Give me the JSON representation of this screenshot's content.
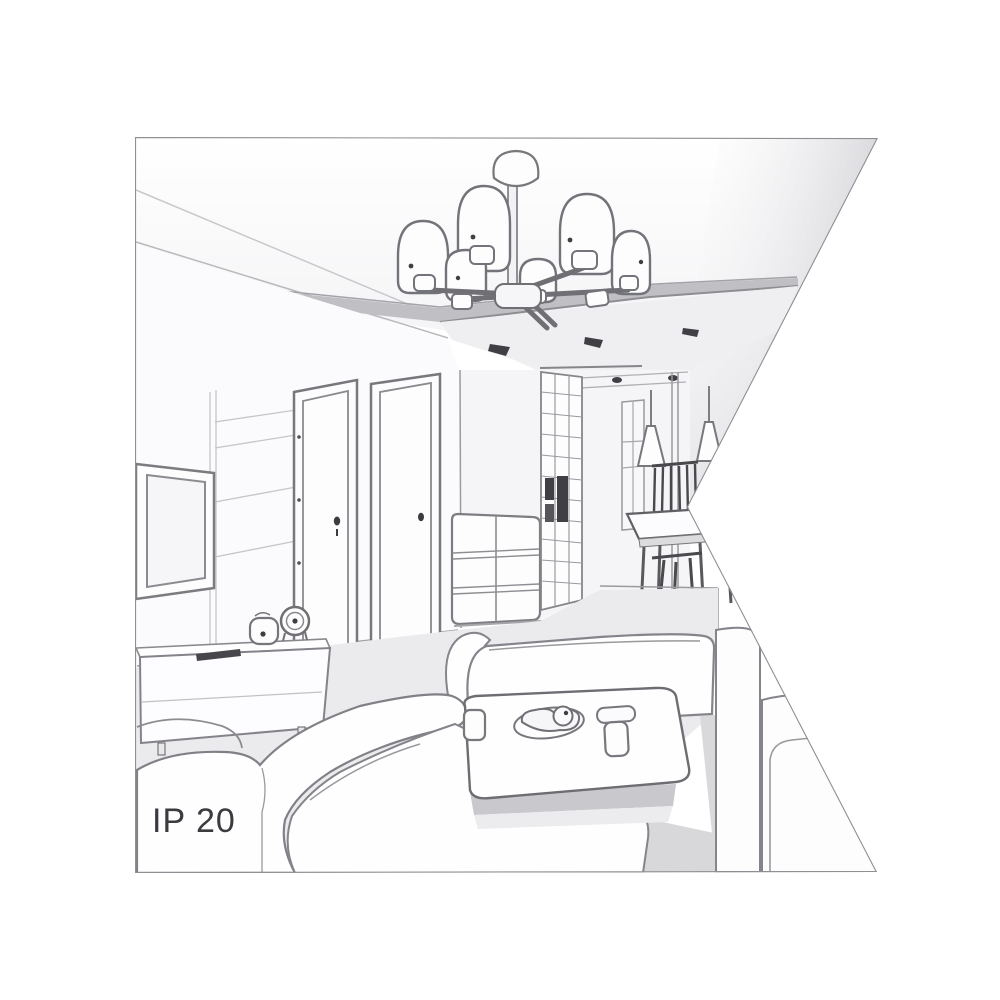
{
  "image": {
    "label": "IP 20",
    "colors": {
      "background": "#ffffff",
      "line": "#8a8a8f",
      "line_dark": "#55555a",
      "accent_dark": "#3f3f44",
      "wall": "#fafafb",
      "floor_shade": "#ebebee",
      "shadow": "#c6c6cb",
      "label_text": "#3a3a3f"
    }
  }
}
